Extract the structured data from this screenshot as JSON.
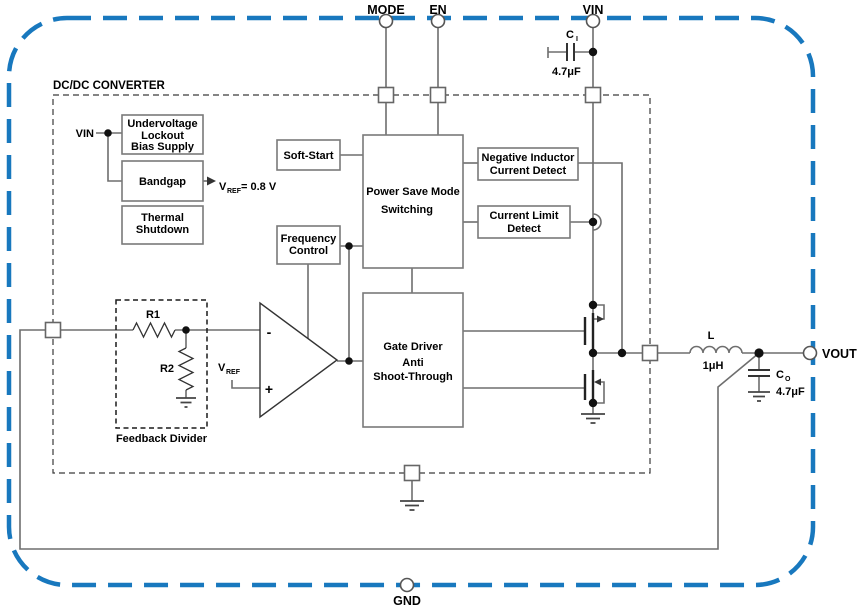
{
  "title": "DC/DC CONVERTER",
  "pins": {
    "mode": "MODE",
    "en": "EN",
    "vin": "VIN",
    "vout": "VOUT",
    "gnd": "GND"
  },
  "blocks": {
    "uvlo": [
      "Undervoltage",
      "Lockout",
      "Bias Supply"
    ],
    "bandgap": "Bandgap",
    "thermal": [
      "Thermal",
      "Shutdown"
    ],
    "soft_start": "Soft-Start",
    "power_save": [
      "Power Save Mode",
      "Switching"
    ],
    "frequency": [
      "Frequency",
      "Control"
    ],
    "neg_inductor": [
      "Negative Inductor",
      "Current Detect"
    ],
    "current_limit": [
      "Current Limit",
      "Detect"
    ],
    "gate_driver": [
      "Gate Driver",
      "Anti",
      "Shoot-Through"
    ]
  },
  "labels": {
    "vin_internal": "VIN",
    "vref_sym": "V",
    "vref_sub": "REF",
    "vref_value": "= 0.8 V",
    "vref2_sym": "V",
    "vref2_sub": "REF",
    "r1": "R1",
    "r2": "R2",
    "feedback_divider": "Feedback Divider",
    "ci_sym": "C",
    "ci_sub": "I",
    "ci_value": "4.7μF",
    "co_sym": "C",
    "co_sub": "O",
    "co_value": "4.7μF",
    "inductor_sym": "L",
    "inductor_value": "1μH",
    "opamp_minus": "-",
    "opamp_plus": "+"
  },
  "colors": {
    "package_border": "#1878be",
    "wire": "#6e6e6e",
    "block_border": "#7a7a7a",
    "text": "#000000"
  }
}
